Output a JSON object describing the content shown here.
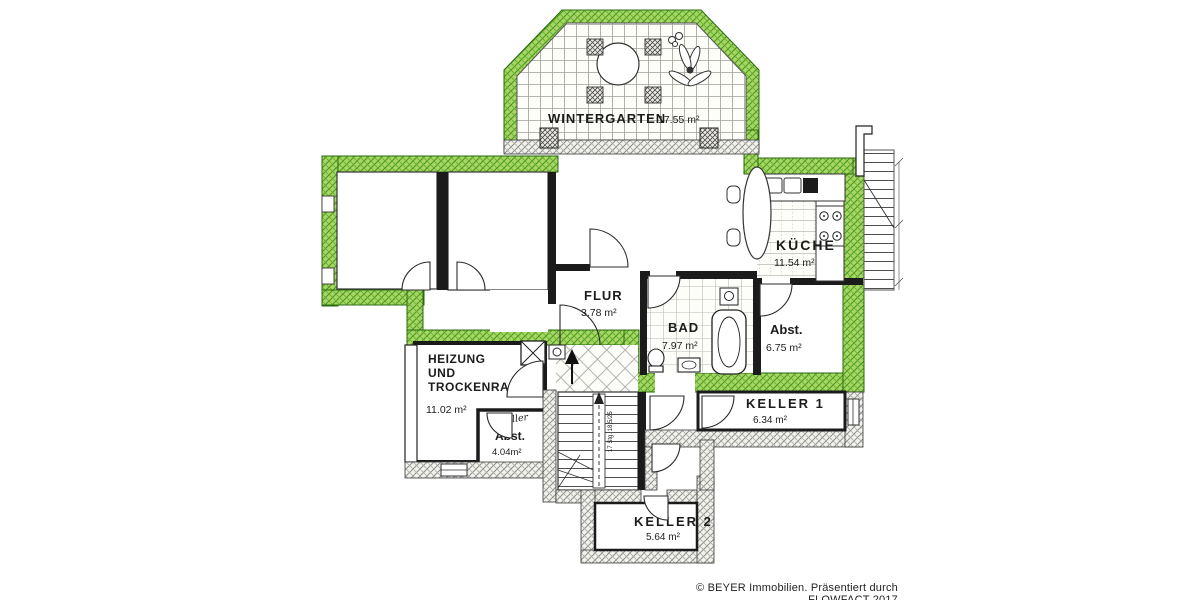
{
  "rooms": {
    "wintergarten": {
      "label": "WINTERGARTEN",
      "area": "17.55 m²"
    },
    "kueche": {
      "label": "KÜCHE",
      "area": "11.54 m²"
    },
    "flur": {
      "label": "FLUR",
      "area": "3.78 m²"
    },
    "bad": {
      "label": "BAD",
      "area": "7.97 m²"
    },
    "abstellraum": {
      "label": "Abst.",
      "area": "6.75 m²"
    },
    "heizung": {
      "label_line1": "HEIZUNG",
      "label_line2": "UND",
      "label_line3": "TROCKENRAUM",
      "area": "11.02 m²"
    },
    "keller_abst": {
      "note": "Keller",
      "label": "Abst.",
      "area": "4.04m²"
    },
    "keller1": {
      "label": "KELLER 1",
      "area": "6.34 m²"
    },
    "keller2": {
      "label": "KELLER 2",
      "area": "5.64 m²"
    }
  },
  "stairs": {
    "annotation": "17 Stg. 18,5/25"
  },
  "footer": {
    "credit": "© BEYER Immobilien. Präsentiert durch FLOWFACT 2017"
  },
  "colors": {
    "highlight_wall_green": "#a8d568",
    "highlight_wall_green_dark": "#4c9a1b",
    "wall_hatch_gray": "#8f8f8a",
    "line_black": "#1b1b1b",
    "paper_white": "#ffffff"
  }
}
